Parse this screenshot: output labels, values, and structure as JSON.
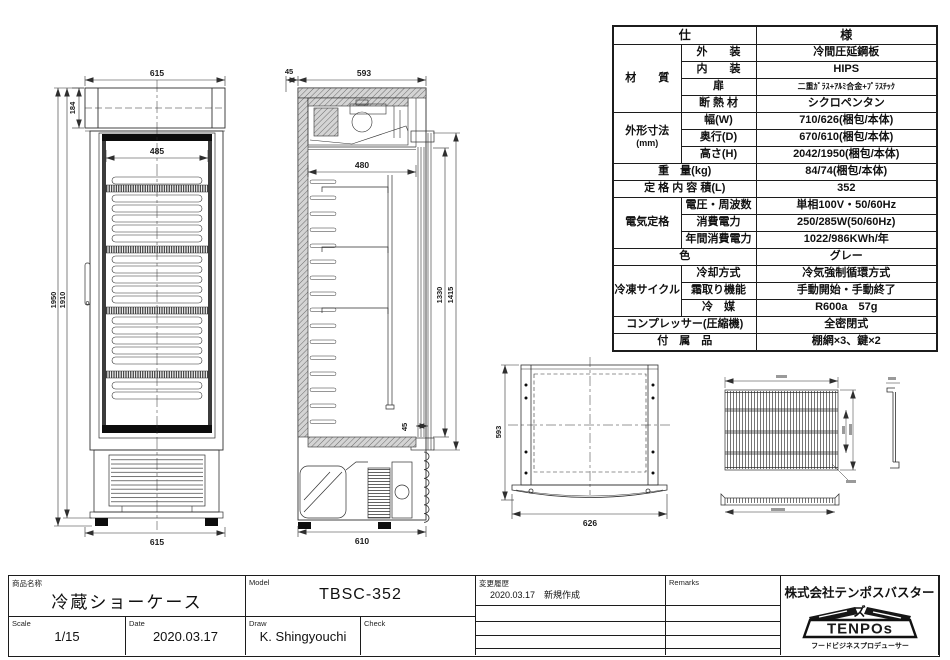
{
  "spec": {
    "title_left": "仕",
    "title_right": "様",
    "material_label": "材　　質",
    "exterior_label": "外　　装",
    "exterior_value": "冷間圧延鋼板",
    "interior_label": "内　　装",
    "interior_value": "HIPS",
    "door_label": "扉",
    "door_value": "二重ｶﾞﾗｽ+ｱﾙﾐ合金+ﾌﾟﾗｽﾁｯｸ",
    "insulation_label": "断 熱 材",
    "insulation_value": "シクロペンタン",
    "dims_label": "外形寸法",
    "dims_unit": "(mm)",
    "width_label": "幅(W)",
    "width_value": "710/626(梱包/本体)",
    "depth_label": "奥行(D)",
    "depth_value": "670/610(梱包/本体)",
    "height_label": "高さ(H)",
    "height_value": "2042/1950(梱包/本体)",
    "weight_label": "重　量(kg)",
    "weight_value": "84/74(梱包/本体)",
    "capacity_label": "定 格 内 容 積(L)",
    "capacity_value": "352",
    "electric_label": "電気定格",
    "voltage_label": "電圧・周波数",
    "voltage_value": "単相100V・50/60Hz",
    "power_label": "消費電力",
    "power_value": "250/285W(50/60Hz)",
    "annual_label": "年間消費電力",
    "annual_value": "1022/986KWh/年",
    "color_label": "色",
    "color_value": "グレー",
    "cycle_label": "冷凍サイクル",
    "cooling_label": "冷却方式",
    "cooling_value": "冷気強制循環方式",
    "defrost_label": "霜取り機能",
    "defrost_value": "手動開始・手動終了",
    "refrigerant_label": "冷　媒",
    "refrigerant_value": "R600a　57g",
    "compressor_label": "コンプレッサー(圧縮機)",
    "compressor_value": "全密閉式",
    "accessories_label": "付　属　品",
    "accessories_value": "棚網×3、鍵×2"
  },
  "dims": {
    "front": {
      "top_width": "615",
      "canopy_height": "184",
      "inner_width": "485",
      "overall_height": "1950",
      "body_height": "1910",
      "bottom_width": "615"
    },
    "side": {
      "back_gap": "45",
      "top_depth": "593",
      "inner_depth": "480",
      "glass_height": "1330",
      "door_height": "1415",
      "front_gap": "45",
      "bottom_depth": "610"
    },
    "plan": {
      "depth": "593",
      "width": "626"
    }
  },
  "tb": {
    "product_label": "商品名称",
    "product_name": "冷蔵ショーケース",
    "model_label": "Model",
    "model_value": "TBSC-352",
    "scale_label": "Scale",
    "scale_value": "1/15",
    "date_label": "Date",
    "date_value": "2020.03.17",
    "draw_label": "Draw",
    "draw_value": "K. Shingyouchi",
    "check_label": "Check",
    "history_label": "変更履歴",
    "history_entry": "2020.03.17　新規作成",
    "remarks_label": "Remarks",
    "company_name": "株式会社テンポスバスターズ",
    "logo_text": "TENPOs",
    "logo_tagline": "フードビジネスプロデューサー"
  }
}
